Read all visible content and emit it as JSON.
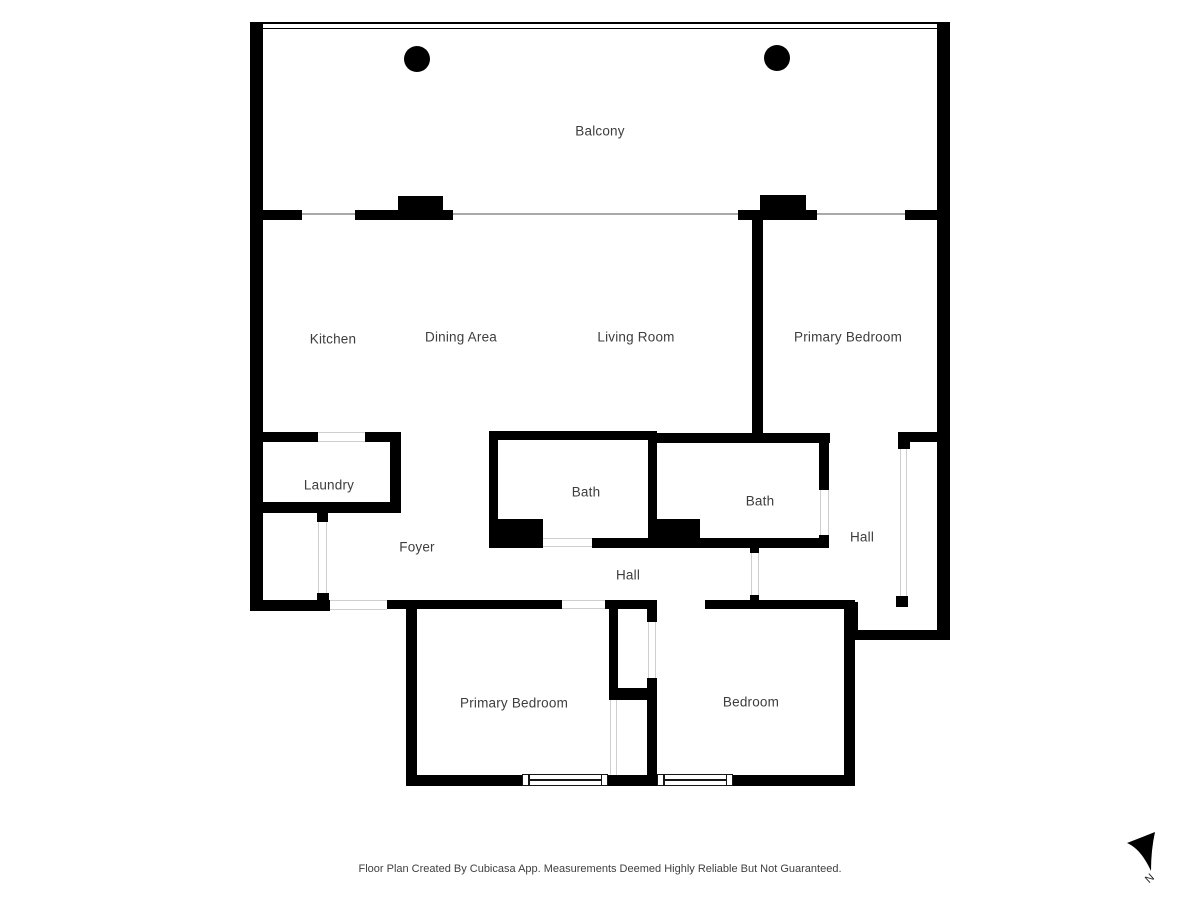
{
  "meta": {
    "footer": "Floor Plan Created By Cubicasa App. Measurements Deemed Highly Reliable But Not Guaranteed.",
    "compass_label": "N"
  },
  "rooms": {
    "balcony": {
      "label": "Balcony"
    },
    "kitchen": {
      "label": "Kitchen"
    },
    "dining": {
      "label": "Dining Area"
    },
    "living": {
      "label": "Living Room"
    },
    "primary_top": {
      "label": "Primary Bedroom"
    },
    "laundry": {
      "label": "Laundry"
    },
    "bath1": {
      "label": "Bath"
    },
    "bath2": {
      "label": "Bath"
    },
    "hall_right": {
      "label": "Hall"
    },
    "foyer": {
      "label": "Foyer"
    },
    "hall_corridor": {
      "label": "Hall"
    },
    "primary_bottom": {
      "label": "Primary Bedroom"
    },
    "bedroom": {
      "label": "Bedroom"
    }
  },
  "colors": {
    "wall": "#000000",
    "label": "#3d3d3d",
    "opening_line": "#cfcfcf",
    "window_line": "#a9a9a9",
    "background": "#ffffff"
  }
}
